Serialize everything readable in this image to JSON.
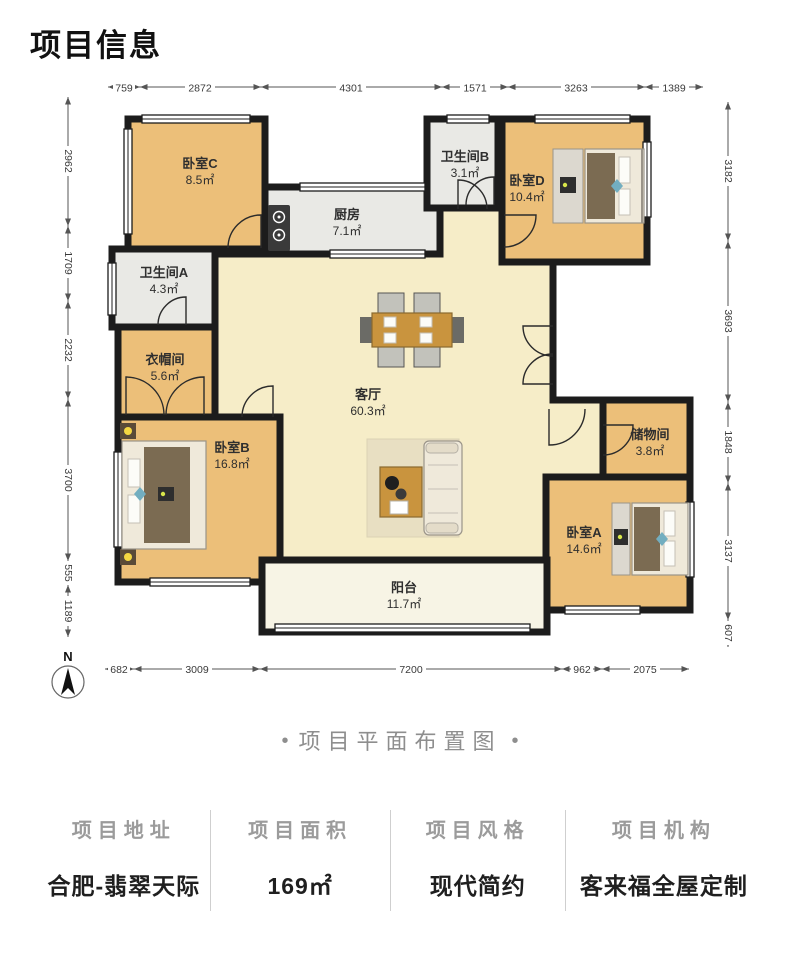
{
  "page": {
    "title": "项目信息",
    "caption": "项目平面布置图",
    "caption_dot": "•"
  },
  "plan": {
    "north_label": "N",
    "rooms": [
      {
        "id": "bedroom-c",
        "name": "卧室C",
        "area": "8.5㎡"
      },
      {
        "id": "bathroom-a",
        "name": "卫生间A",
        "area": "4.3㎡"
      },
      {
        "id": "cloakroom",
        "name": "衣帽间",
        "area": "5.6㎡"
      },
      {
        "id": "bedroom-b",
        "name": "卧室B",
        "area": "16.8㎡"
      },
      {
        "id": "kitchen",
        "name": "厨房",
        "area": "7.1㎡"
      },
      {
        "id": "bathroom-b",
        "name": "卫生间B",
        "area": "3.1㎡"
      },
      {
        "id": "bedroom-d",
        "name": "卧室D",
        "area": "10.4㎡"
      },
      {
        "id": "living-room",
        "name": "客厅",
        "area": "60.3㎡"
      },
      {
        "id": "storage",
        "name": "储物间",
        "area": "3.8㎡"
      },
      {
        "id": "bedroom-a",
        "name": "卧室A",
        "area": "14.6㎡"
      },
      {
        "id": "balcony",
        "name": "阳台",
        "area": "11.7㎡"
      }
    ],
    "dimensions": {
      "top": [
        "759",
        "2872",
        "4301",
        "1571",
        "3263",
        "1389"
      ],
      "left": [
        "2962",
        "1709",
        "2232",
        "3700",
        "555",
        "1189"
      ],
      "right": [
        "3182",
        "3693",
        "1848",
        "3137",
        "607"
      ],
      "bottom": [
        "682",
        "3009",
        "7200",
        "962",
        "2075"
      ]
    },
    "colors": {
      "wall": "#1c1c1c",
      "wood_floor": "#ecbf79",
      "tile_floor": "#e9e9e5",
      "living_floor": "#f6edc8",
      "balcony_floor": "#f7f4e5"
    }
  },
  "info": {
    "columns": [
      {
        "label": "项目地址",
        "value": "合肥-翡翠天际"
      },
      {
        "label": "项目面积",
        "value": "169㎡"
      },
      {
        "label": "项目风格",
        "value": "现代简约"
      },
      {
        "label": "项目机构",
        "value": "客来福全屋定制"
      }
    ]
  }
}
